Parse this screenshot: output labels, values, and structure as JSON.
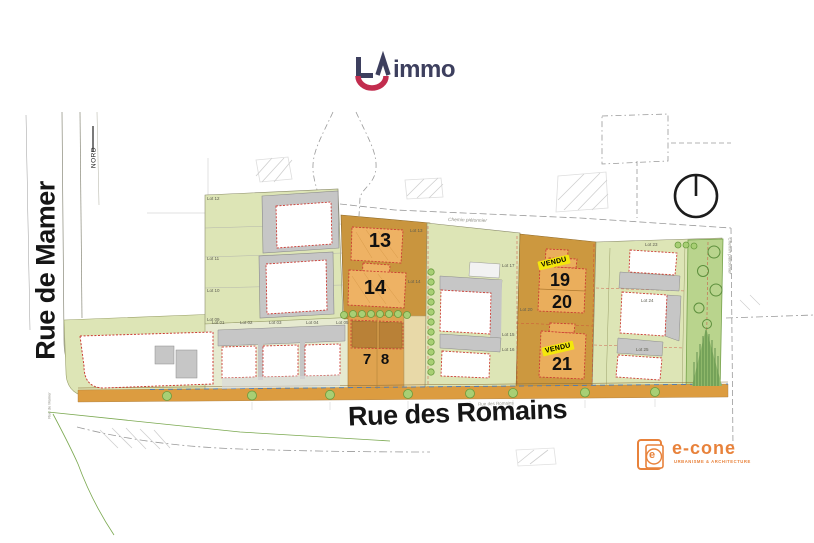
{
  "brand": {
    "mark": "LA",
    "name": "immo",
    "navy": "#3d3f5e",
    "red": "#c22c4e"
  },
  "plan": {
    "north_label": "NORD",
    "streets": {
      "left_big": "Rue de Mamer",
      "left_small": "Rue de Mamer",
      "bottom_big": "Rue des Romains",
      "bottom_small": "Rue des Romains",
      "path_top": "Chemin piétonnier",
      "path_right": "Chemin piétonnier"
    },
    "sold_label": "VENDU",
    "units": [
      {
        "number": "13",
        "sold": false
      },
      {
        "number": "14",
        "sold": false
      },
      {
        "number": "7",
        "sold": false
      },
      {
        "number": "8",
        "sold": false
      },
      {
        "number": "19",
        "sold": true
      },
      {
        "number": "20",
        "sold": false
      },
      {
        "number": "21",
        "sold": true
      }
    ],
    "lot_labels": [
      "Lot 12",
      "Lot 11",
      "Lot 10",
      "Lot 09",
      "Lot 13",
      "Lot 14",
      "Lot 17",
      "Lot 20",
      "Lot 15",
      "Lot 16",
      "Lot 23",
      "Lot 24",
      "Lot 25",
      "Lot 01",
      "Lot 02",
      "Lot 03",
      "Lot 04",
      "Lot 05"
    ],
    "colors": {
      "parcel_green": "#dde5b6",
      "parcel_orange": "#cc983f",
      "building_orange": "#eeb264",
      "sidewalk_orange": "#dc9c40",
      "sold_yellow": "#f4e70b",
      "tree_green": "#a8cf74",
      "boundary_red": "#cc3b34"
    }
  },
  "econe": {
    "icon_letter": "e",
    "name": "e-cone",
    "tagline": "URBANISME & ARCHITECTURE",
    "color": "#e8823b"
  }
}
